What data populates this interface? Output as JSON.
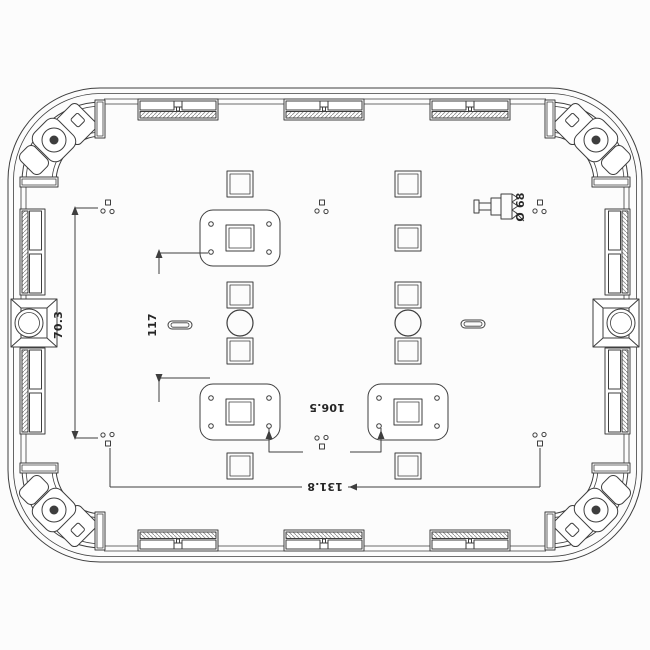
{
  "drawing": {
    "background": "#fcfcfc",
    "line_color": "#3e3e3e",
    "hatch_color": "#8f8f8f",
    "text_color": "#262626",
    "labels": {
      "dim_height_left": "70.3",
      "dim_pitch": "117",
      "dim_pad_spacing": "106.5",
      "dim_overall": "131.8",
      "dim_diameter": "Ø 68"
    }
  }
}
